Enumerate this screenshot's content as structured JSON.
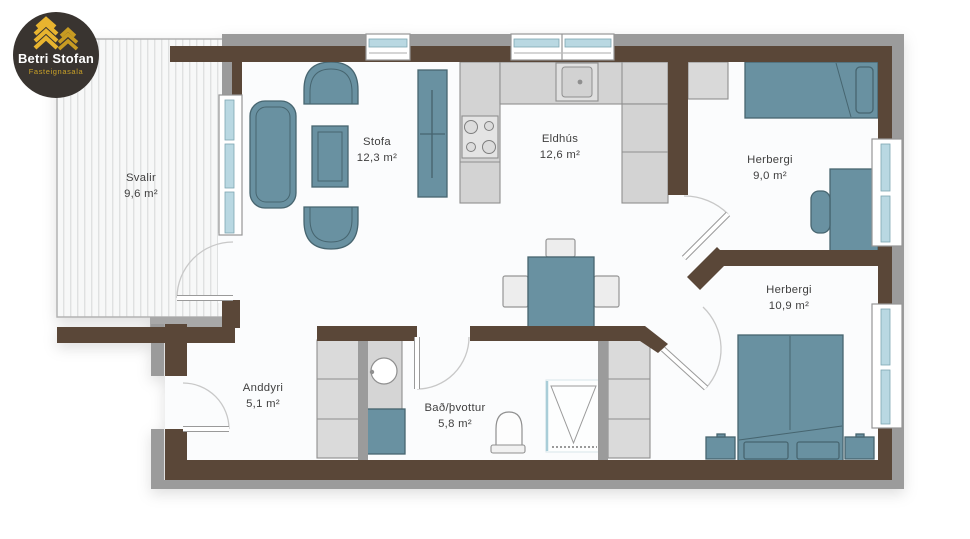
{
  "logo": {
    "title": "Betri Stofan",
    "subtitle": "Fasteignasala"
  },
  "rooms": [
    {
      "id": "svalir",
      "name": "Svalir",
      "area": "9,6 m²"
    },
    {
      "id": "stofa",
      "name": "Stofa",
      "area": "12,3 m²"
    },
    {
      "id": "eldhus",
      "name": "Eldhús",
      "area": "12,6 m²"
    },
    {
      "id": "herbergi-1",
      "name": "Herbergi",
      "area": "9,0 m²"
    },
    {
      "id": "herbergi-2",
      "name": "Herbergi",
      "area": "10,9 m²"
    },
    {
      "id": "anddyri",
      "name": "Anddyri",
      "area": "5,1 m²"
    },
    {
      "id": "bad-thvottur",
      "name": "Bað/þvottur",
      "area": "5,8 m²"
    }
  ],
  "colors": {
    "wall_brown": "#5a4638",
    "wall_gray": "#9b9b9b",
    "furniture_teal": "#6991a1",
    "furniture_teal_stroke": "#46656f",
    "furniture_gray": "#d3d3d3",
    "window_glass": "#b9d8e2",
    "floor": "#fbfcfd",
    "logo_bg": "#393430",
    "logo_gold": "#e0ac2c"
  }
}
